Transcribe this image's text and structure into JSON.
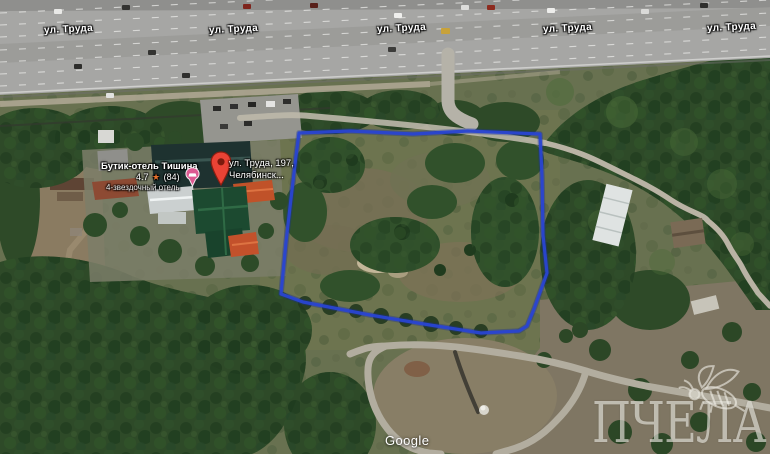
{
  "map_labels": {
    "street": [
      {
        "text": "ул. Труда"
      },
      {
        "text": "ул. Труда"
      },
      {
        "text": "ул. Труда"
      },
      {
        "text": "ул. Труда"
      },
      {
        "text": "ул. Труда"
      }
    ]
  },
  "hotel_card": {
    "name": "Бутик-отель Тишина",
    "rating": "4.7",
    "star_icon": "★",
    "review_count": "(84)",
    "category": "4-звездочный отель"
  },
  "address_card": {
    "line1": "ул. Труда, 197,",
    "line2": "Челябинск..."
  },
  "attribution": {
    "google": "Google"
  },
  "watermark": {
    "brand": "ПЧЕЛА"
  },
  "icons": {
    "marker": "red-map-pin",
    "lodging": "pink-bed-pin",
    "star": "★",
    "bee": "bee-line-art"
  },
  "colors": {
    "parcel_outline_blue": "#2945d2",
    "marker_red": "#EA4335",
    "lodging_pin_pink": "#dd5a92",
    "rating_star_orange": "#e8702a"
  }
}
